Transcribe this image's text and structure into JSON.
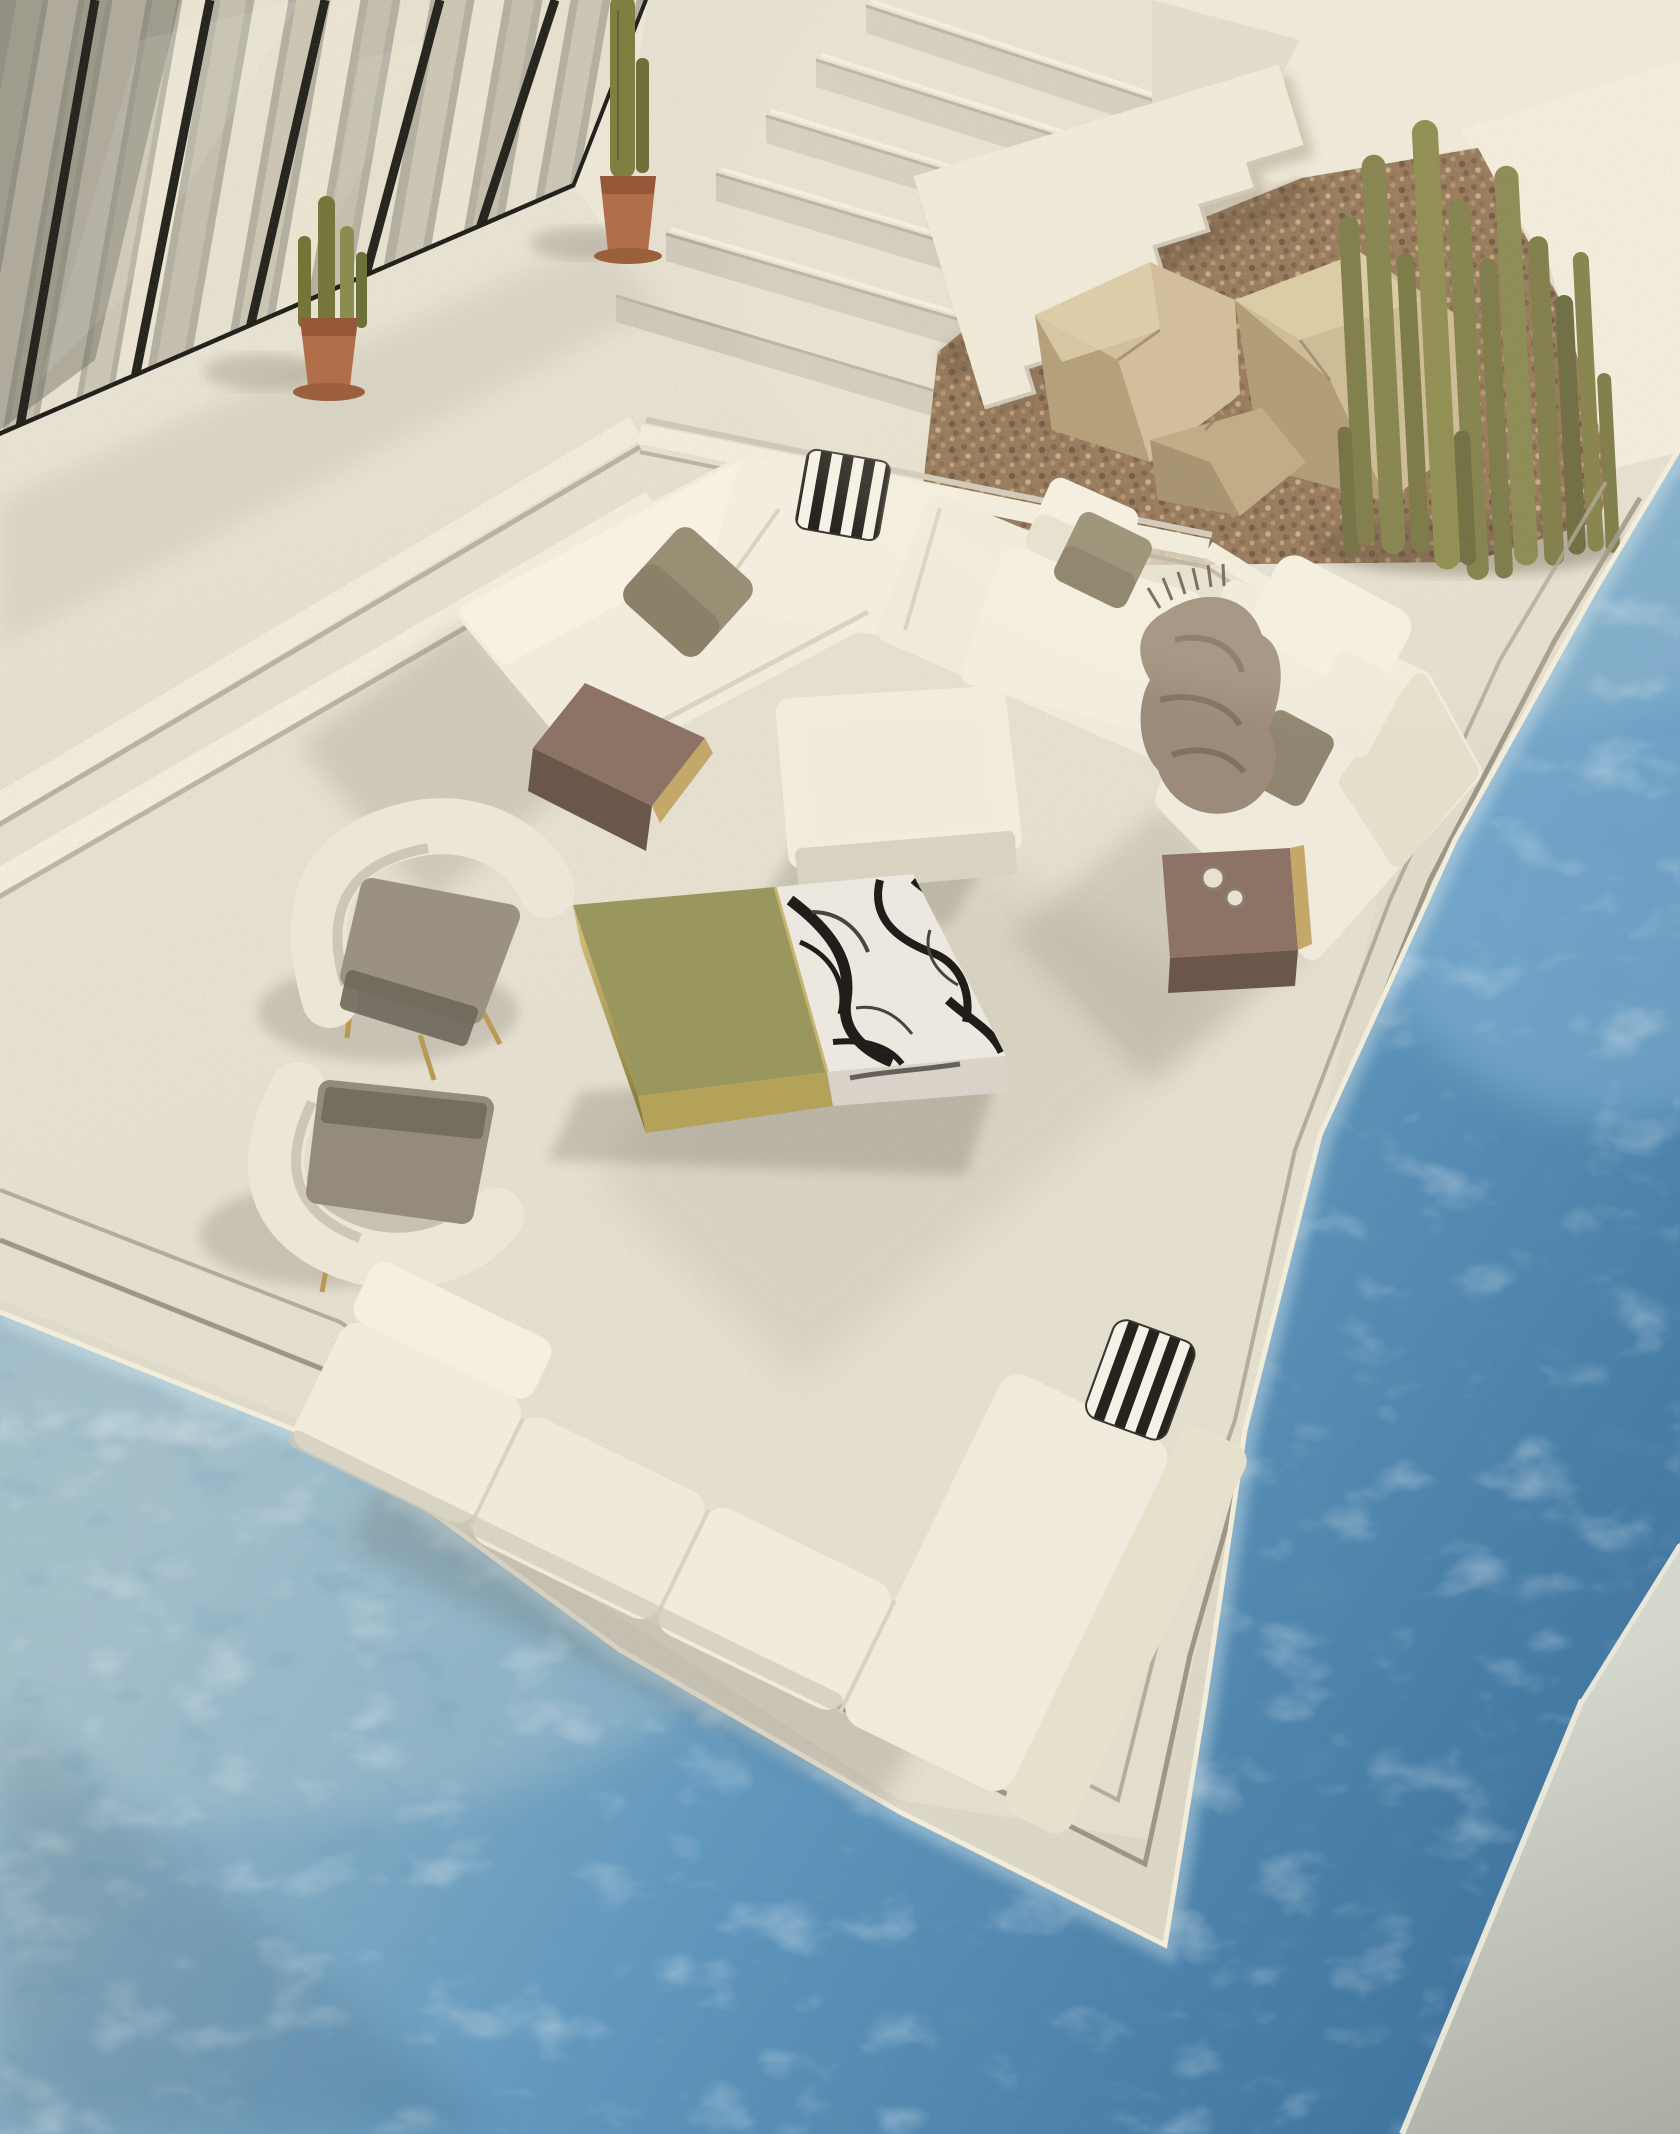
{
  "scene": {
    "title": "Aerial render of a sunken outdoor lounge terrace beside a swimming pool",
    "setting": "Top-down afternoon view: white stucco terrace with sunken seating pit, cream modular sofas, marble and bronze tables, cactus planter, staircase, glass wall with curtains, and wrap-around pool water",
    "light": "warm sun from upper right, long soft shadows to lower left",
    "palette": {
      "terrace_light": "#ece6d7",
      "terrace_mid": "#ddd7c8",
      "terrace_shade": "#c9c3b5",
      "wall_white": "#efe9da",
      "stair_tread": "#e7e1d2",
      "stair_riser": "#d2ccbd",
      "sofa_cream": "#f0ebdc",
      "sofa_shade": "#d8d2c1",
      "sofa_dark": "#b7b1a1",
      "pillow_taupe": "#998f75",
      "pillow_taupe_dark": "#7f7660",
      "stripe_black": "#26231f",
      "stripe_white": "#f4f1e6",
      "blanket": "#9c8b7a",
      "blanket_dark": "#7b6a5a",
      "bronze_top": "#8c7365",
      "bronze_side": "#6b564a",
      "brass": "#c3a86a",
      "marble_white": "#ece7df",
      "marble_vein": "#201d1a",
      "gold_sleeve": "#99975e",
      "armchair_shell": "#ece6d6",
      "armchair_seat": "#9a9180",
      "cactus": "#77763c",
      "cactus_dark": "#5c5b2c",
      "pot_terracotta": "#b06f48",
      "gravel_base": "#8a6a4c",
      "rock_light": "#cdb892",
      "rock_shade": "#a58d66",
      "water_haze": "#9dbac7",
      "water_mid": "#6197bd",
      "water_deep": "#3c719b",
      "foam": "#f2ecdb",
      "glass_base": "#b3b0a2",
      "curtain": "#e8e1cf",
      "curtain_shade": "#cdc6b4",
      "mullion": "#23211b",
      "corner_band": "#c6cabf"
    },
    "objects": {
      "seating": [
        "top L-shaped cream modular sofa",
        "right corner chaise module",
        "bottom L-shaped cream modular sofa",
        "square cream ottoman",
        "two taupe-and-cream armchairs with brass legs"
      ],
      "pillows": [
        "black-white striped pillow on top sofa corner",
        "black-white striped pillow on bottom sofa armrest",
        "taupe square pillows",
        "cream pillows"
      ],
      "tables": [
        "block coffee table of black-veined marble with olive-gold metal sleeve",
        "bronze waterfall side table on top sofa arm",
        "bronze waterfall side table at chaise foot with two cups"
      ],
      "textile": "taupe fringed throw blanket draped over chaise",
      "plants": [
        "cluster of columnar olive cacti in gravel planter",
        "small potted cactus by glass wall",
        "tall potted cactus at stair corner"
      ],
      "architecture": [
        "floor-to-ceiling glass wall with cream curtains and black mullions",
        "white staircase",
        "zigzag stair parapet",
        "gravel and rock bed",
        "sunken lounge pit with step rims and groove lines",
        "swimming pool wrapping two sides",
        "far pool edge in bottom-right corner"
      ]
    }
  }
}
